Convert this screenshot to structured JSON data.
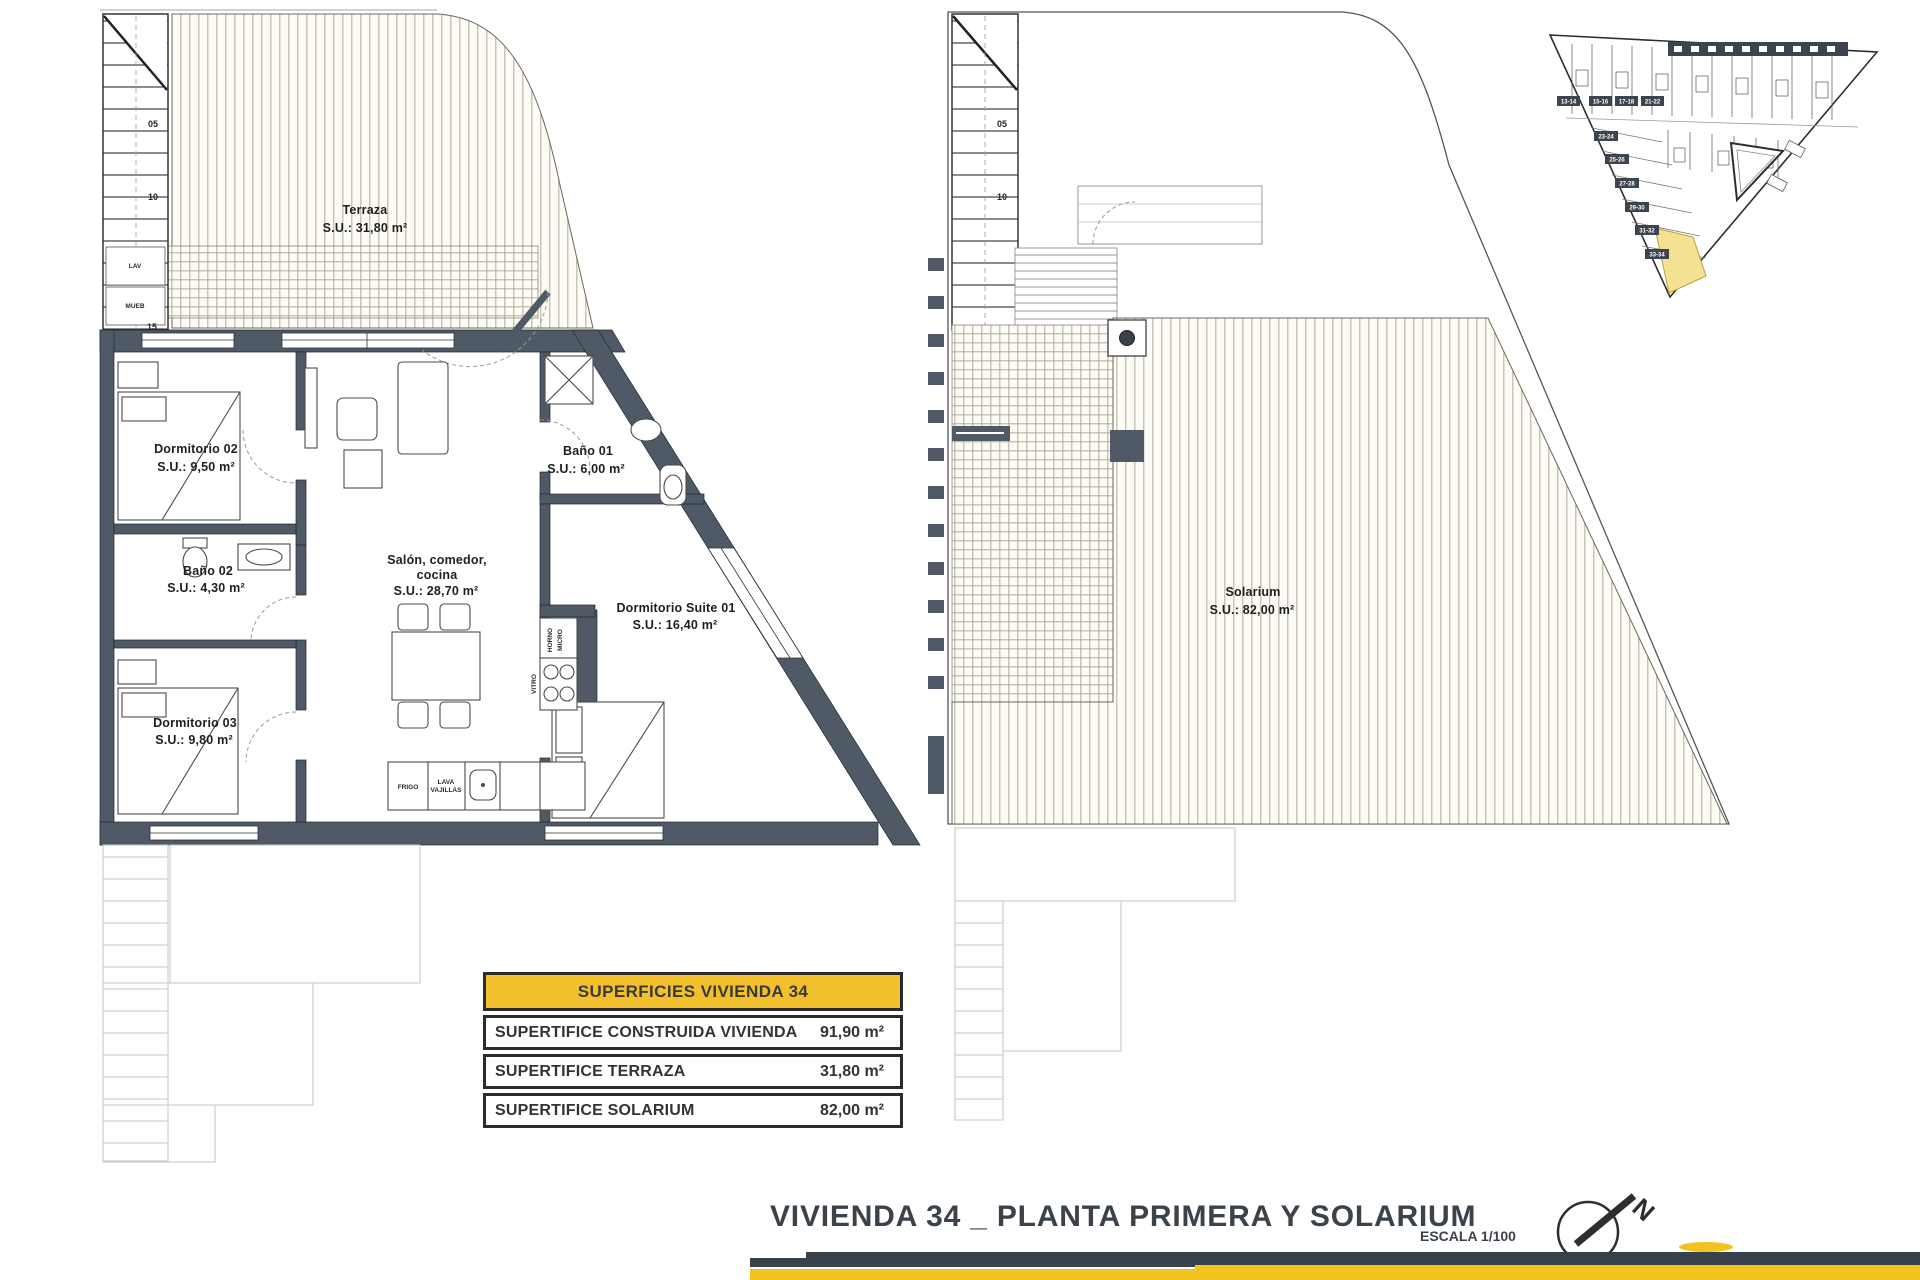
{
  "colors": {
    "wall": "#4f5a66",
    "accent_yellow": "#f2c02c",
    "footer_dark": "#39414a",
    "site_highlight": "#f5e193"
  },
  "left_plan": {
    "terraza": {
      "name": "Terraza",
      "area": "S.U.: 31,80 m²"
    },
    "dorm02": {
      "name": "Dormitorio 02",
      "area": "S.U.: 9,50 m²"
    },
    "bano01": {
      "name": "Baño 01",
      "area": "S.U.: 6,00 m²"
    },
    "bano02": {
      "name": "Baño 02",
      "area": "S.U.: 4,30 m²"
    },
    "salon": {
      "line1": "Salón, comedor,",
      "line2": "cocina",
      "area": "S.U.: 28,70 m²"
    },
    "suite": {
      "name": "Dormitorio Suite 01",
      "area": "S.U.: 16,40 m²"
    },
    "dorm03": {
      "name": "Dormitorio 03",
      "area": "S.U.: 9,80 m²"
    },
    "stairs": {
      "n05": "05",
      "n10": "10",
      "n15": "15"
    },
    "closets": {
      "lav": "LAV",
      "mueb": "MUEB"
    },
    "kitchen": {
      "frigo": "FRIGO",
      "lava1": "LAVA",
      "lava2": "VAJILLAS",
      "horno": "HORNO",
      "micro": "MICRO",
      "vitro": "VITRO"
    }
  },
  "right_plan": {
    "solarium": {
      "name": "Solarium",
      "area": "S.U.: 82,00 m²"
    },
    "stairs": {
      "n05": "05",
      "n10": "10"
    }
  },
  "site_plan": {
    "top_units": [
      "13-14",
      "15-16",
      "17-18",
      "21-22"
    ],
    "side_units": [
      "23-24",
      "25-26",
      "27-28",
      "29-30",
      "31-32",
      "33-34"
    ]
  },
  "table": {
    "header": "SUPERFICIES VIVIENDA 34",
    "rows": [
      {
        "label": "SUPERTIFICE CONSTRUIDA VIVIENDA",
        "value": "91,90 m²"
      },
      {
        "label": "SUPERTIFICE TERRAZA",
        "value": "31,80 m²"
      },
      {
        "label": "SUPERTIFICE SOLARIUM",
        "value": "82,00 m²"
      }
    ]
  },
  "footer": {
    "title": "VIVIENDA 34 _ PLANTA PRIMERA Y SOLARIUM",
    "scale": "ESCALA 1/100",
    "north": "N"
  }
}
